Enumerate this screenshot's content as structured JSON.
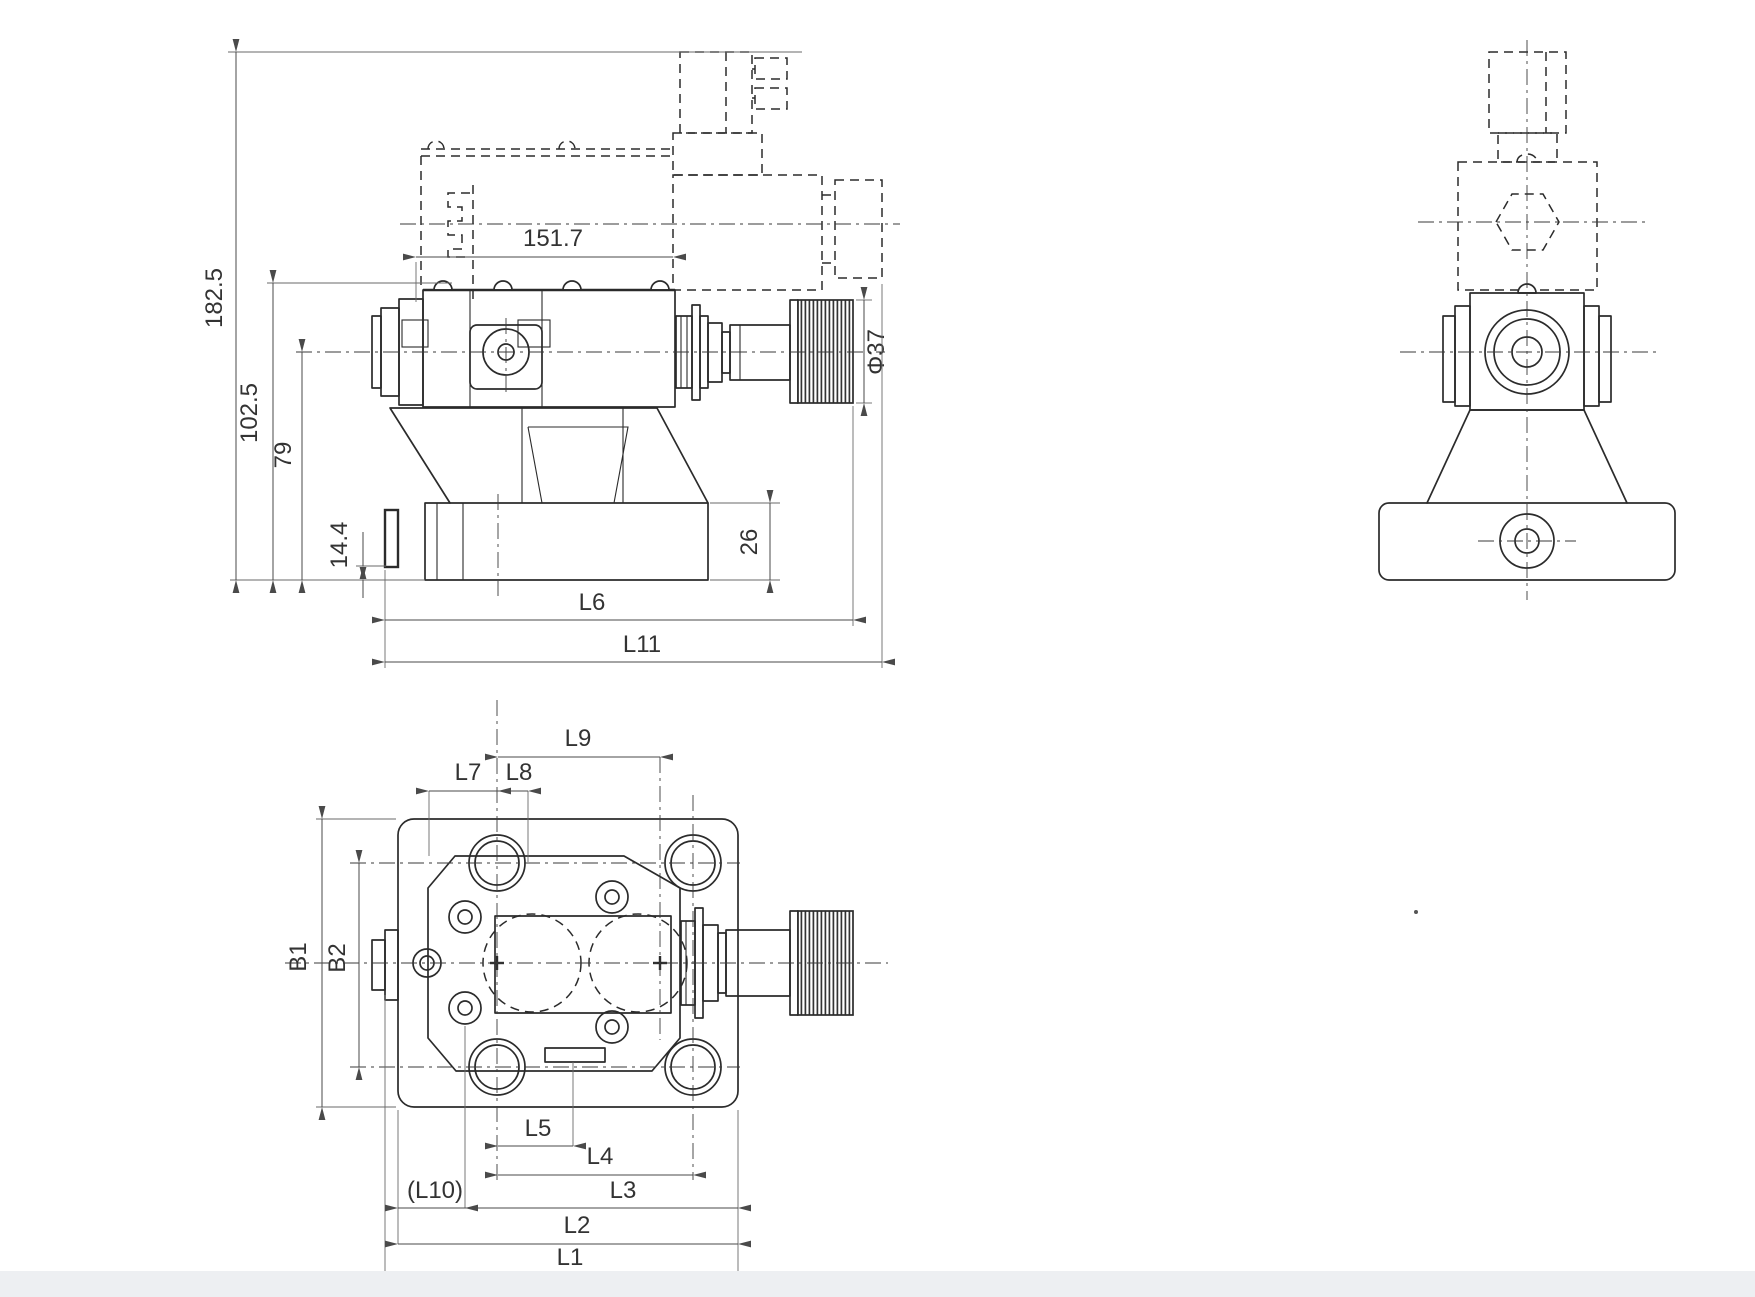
{
  "front": {
    "total_height": "182.5",
    "upper_height": "102.5",
    "axis_height": "79",
    "tab_height": "14.4",
    "solenoid_length": "151.7",
    "knob_diameter": "Φ37",
    "base_height": "26",
    "base_length": "L6",
    "total_length": "L11"
  },
  "plan": {
    "l9": "L9",
    "l7": "L7",
    "l8": "L8",
    "b1": "B1",
    "b2": "B2",
    "l5": "L5",
    "l4": "L4",
    "l3": "L3",
    "l10": "(L10)",
    "l2": "L2",
    "l1": "L1"
  },
  "colors": {
    "line": "#2b2b2b",
    "dimension": "#4a4a4a",
    "background": "#ffffff",
    "footer_strip": "#edeff2"
  }
}
